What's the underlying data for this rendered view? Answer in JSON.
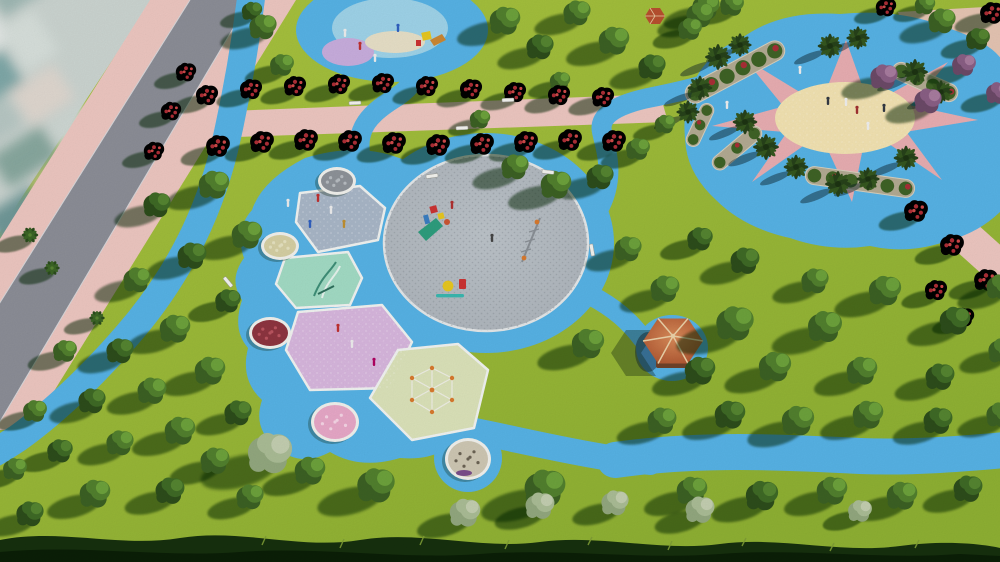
{
  "scene": {
    "title": "Aerial 3D render of a park masterplan with circular playground, sun-motif plaza, gazebo and tree-lined paths",
    "objects": [
      {
        "name": "city-backdrop",
        "label": "blurred city blocks beyond road"
      },
      {
        "name": "main-road",
        "label": "diagonal asphalt road with pink sidewalks"
      },
      {
        "name": "roadside-blue-path",
        "label": "blue walking path parallel to road"
      },
      {
        "name": "flower-promenade",
        "label": "pink promenade lined with red flowering trees"
      },
      {
        "name": "central-playground",
        "label": "blue play zone with grey circular plaza and play patches"
      },
      {
        "name": "play-patches",
        "label": "slate, mint, lilac and lime coloured play surfaces"
      },
      {
        "name": "flower-planters",
        "label": "round white-rim planters with pebbles and flowers"
      },
      {
        "name": "sun-plaza",
        "label": "blue plaza with cream sun and pink rays ringed by palms"
      },
      {
        "name": "gazebo",
        "label": "hexagonal terracotta-roof gazebo on blue pad"
      },
      {
        "name": "tree-field",
        "label": "lawn with rows of round trees casting long shadows"
      },
      {
        "name": "foreground-hedge",
        "label": "dark grass hedge silhouette along bottom edge"
      }
    ],
    "palette": {
      "grass1": "#aac43f",
      "grass2": "#8fb133",
      "blue": "#57b3e6",
      "blue2": "#6fc0ec",
      "pink_walk": "#eec7c1",
      "road": "#8c8e97",
      "curb": "#d9d9dc",
      "plaza_gray": "#bdc4ca",
      "plaza_speck": "#8f969d",
      "sun_cream": "#f3e3b2",
      "ray_pink": "#e9aeb2",
      "patch_slate": "#a9b7c8",
      "patch_mint": "#a3dcc5",
      "patch_lilac": "#d8b7de",
      "patch_lime": "#dce3ba",
      "patch_border": "#f2f4f2",
      "roof1": "#d98b59",
      "roof2": "#a84e2b",
      "ridge": "#ecd2a8",
      "deck": "#6e422a",
      "stone": "#b3ab93",
      "shrub": "#3f6326",
      "shrub_red": "#a82f36",
      "tree_g1": "#3c6124",
      "tree_g2": "#52802e",
      "tree_g3": "#6da23c",
      "tree_d1": "#2d4d1b",
      "tree_d2": "#3f6a26",
      "tree_d3": "#558531",
      "tree_p1": "#93a87f",
      "tree_p2": "#abbd96",
      "tree_p3": "#c4cfb1",
      "tree_u1": "#6c4a68",
      "tree_u2": "#8a5f85",
      "tree_u3": "#a87c9f",
      "tree_n1": "#2b4c1c",
      "tree_n2": "#3c6526",
      "tree_n3": "#588433",
      "palm_1": "#27421a",
      "palm_2": "#35571f",
      "palm_3": "#1d3312",
      "red_dot1": "#ad2e36",
      "red_dot2": "#cf4a4a",
      "shadow": "rgba(12,34,10,0.5)",
      "hedge1": "#16300e",
      "hedge2": "#0b1f07",
      "hedge_lit": "#7f9e36",
      "city_base": "#ccd5d1"
    },
    "trees": [
      [
        "d",
        252,
        12,
        0.6
      ],
      [
        "g",
        263,
        28,
        0.8
      ],
      [
        "g",
        282,
        66,
        0.7
      ],
      [
        "g",
        505,
        22,
        0.9
      ],
      [
        "d",
        540,
        48,
        0.8
      ],
      [
        "g",
        577,
        14,
        0.8
      ],
      [
        "g",
        614,
        42,
        0.9
      ],
      [
        "d",
        652,
        68,
        0.8
      ],
      [
        "g",
        690,
        30,
        0.7
      ],
      [
        "g",
        706,
        8,
        0.8
      ],
      [
        "g",
        560,
        82,
        0.6
      ],
      [
        "g",
        480,
        120,
        0.6
      ],
      [
        "g",
        515,
        168,
        0.8
      ],
      [
        "g",
        556,
        186,
        0.9
      ],
      [
        "d",
        600,
        178,
        0.8
      ],
      [
        "g",
        638,
        150,
        0.7
      ],
      [
        "g",
        665,
        125,
        0.6
      ],
      [
        "g",
        700,
        16,
        0.8
      ],
      [
        "g",
        732,
        6,
        0.7
      ],
      [
        "r",
        886,
        8,
        0.6
      ],
      [
        "g",
        925,
        6,
        0.6
      ],
      [
        "g",
        942,
        22,
        0.8
      ],
      [
        "d",
        978,
        40,
        0.7
      ],
      [
        "r",
        992,
        14,
        0.7
      ],
      [
        "u",
        884,
        78,
        0.8
      ],
      [
        "u",
        928,
        102,
        0.8
      ],
      [
        "u",
        964,
        66,
        0.7
      ],
      [
        "u",
        998,
        94,
        0.7
      ],
      [
        "r",
        207,
        96,
        0.65
      ],
      [
        "r",
        251,
        90,
        0.65
      ],
      [
        "r",
        295,
        87,
        0.65
      ],
      [
        "r",
        339,
        85,
        0.65
      ],
      [
        "r",
        383,
        84,
        0.65
      ],
      [
        "r",
        427,
        87,
        0.65
      ],
      [
        "r",
        471,
        90,
        0.65
      ],
      [
        "r",
        515,
        93,
        0.65
      ],
      [
        "r",
        559,
        96,
        0.65
      ],
      [
        "r",
        603,
        98,
        0.65
      ],
      [
        "r",
        218,
        147,
        0.7
      ],
      [
        "r",
        262,
        143,
        0.7
      ],
      [
        "r",
        306,
        141,
        0.7
      ],
      [
        "r",
        350,
        142,
        0.7
      ],
      [
        "r",
        394,
        144,
        0.7
      ],
      [
        "r",
        438,
        146,
        0.7
      ],
      [
        "r",
        482,
        145,
        0.7
      ],
      [
        "r",
        526,
        143,
        0.7
      ],
      [
        "r",
        570,
        141,
        0.7
      ],
      [
        "r",
        614,
        142,
        0.7
      ],
      [
        "r",
        186,
        73,
        0.6
      ],
      [
        "r",
        171,
        112,
        0.6
      ],
      [
        "r",
        154,
        152,
        0.6
      ],
      [
        "r",
        916,
        212,
        0.7
      ],
      [
        "r",
        952,
        246,
        0.7
      ],
      [
        "r",
        986,
        281,
        0.7
      ],
      [
        "r",
        936,
        291,
        0.65
      ],
      [
        "r",
        964,
        318,
        0.6
      ],
      [
        "g",
        214,
        186,
        0.9
      ],
      [
        "d",
        157,
        206,
        0.8
      ],
      [
        "n",
        30,
        235,
        0.75
      ],
      [
        "g",
        247,
        236,
        0.9
      ],
      [
        "d",
        192,
        257,
        0.85
      ],
      [
        "n",
        52,
        268,
        0.7
      ],
      [
        "g",
        137,
        281,
        0.8
      ],
      [
        "d",
        228,
        302,
        0.75
      ],
      [
        "n",
        97,
        318,
        0.7
      ],
      [
        "g",
        175,
        330,
        0.9
      ],
      [
        "d",
        120,
        352,
        0.8
      ],
      [
        "g",
        65,
        352,
        0.7
      ],
      [
        "g",
        210,
        372,
        0.9
      ],
      [
        "g",
        152,
        392,
        0.85
      ],
      [
        "d",
        92,
        402,
        0.8
      ],
      [
        "g",
        35,
        412,
        0.7
      ],
      [
        "d",
        238,
        414,
        0.8
      ],
      [
        "g",
        180,
        432,
        0.9
      ],
      [
        "g",
        120,
        444,
        0.8
      ],
      [
        "d",
        60,
        452,
        0.75
      ],
      [
        "g",
        15,
        470,
        0.7
      ],
      [
        "g",
        215,
        462,
        0.85
      ],
      [
        "p",
        270,
        455,
        1.3
      ],
      [
        "g",
        95,
        495,
        0.9
      ],
      [
        "d",
        170,
        492,
        0.85
      ],
      [
        "g",
        250,
        498,
        0.8
      ],
      [
        "d",
        30,
        515,
        0.8
      ],
      [
        "g",
        310,
        472,
        0.9
      ],
      [
        "g",
        376,
        487,
        1.1
      ],
      [
        "g",
        545,
        490,
        1.2
      ],
      [
        "p",
        465,
        514,
        0.9
      ],
      [
        "p",
        540,
        507,
        0.85
      ],
      [
        "p",
        615,
        504,
        0.8
      ],
      [
        "p",
        700,
        511,
        0.85
      ],
      [
        "p",
        860,
        512,
        0.7
      ],
      [
        "g",
        628,
        250,
        0.8
      ],
      [
        "g",
        665,
        290,
        0.85
      ],
      [
        "g",
        588,
        345,
        0.95
      ],
      [
        "d",
        700,
        240,
        0.75
      ],
      [
        "g",
        735,
        325,
        1.1
      ],
      [
        "g",
        825,
        328,
        1.0
      ],
      [
        "g",
        885,
        292,
        0.95
      ],
      [
        "d",
        955,
        322,
        0.9
      ],
      [
        "d",
        745,
        262,
        0.85
      ],
      [
        "g",
        815,
        282,
        0.8
      ],
      [
        "g",
        1000,
        288,
        0.8
      ],
      [
        "d",
        700,
        372,
        0.9
      ],
      [
        "g",
        775,
        368,
        0.95
      ],
      [
        "g",
        862,
        372,
        0.9
      ],
      [
        "d",
        940,
        378,
        0.85
      ],
      [
        "g",
        1002,
        352,
        0.8
      ],
      [
        "g",
        662,
        422,
        0.85
      ],
      [
        "d",
        730,
        416,
        0.9
      ],
      [
        "g",
        798,
        422,
        0.95
      ],
      [
        "g",
        868,
        416,
        0.9
      ],
      [
        "d",
        938,
        422,
        0.85
      ],
      [
        "g",
        1000,
        416,
        0.8
      ],
      [
        "g",
        692,
        492,
        0.9
      ],
      [
        "d",
        762,
        497,
        0.95
      ],
      [
        "g",
        832,
        492,
        0.9
      ],
      [
        "g",
        902,
        497,
        0.9
      ],
      [
        "d",
        968,
        490,
        0.85
      ],
      [
        "m",
        718,
        57,
        1
      ],
      [
        "m",
        740,
        45,
        0.9
      ],
      [
        "m",
        700,
        88,
        0.95
      ],
      [
        "m",
        830,
        46,
        0.95
      ],
      [
        "m",
        858,
        38,
        0.9
      ],
      [
        "m",
        915,
        72,
        1
      ],
      [
        "m",
        941,
        92,
        0.9
      ],
      [
        "m",
        745,
        122,
        0.95
      ],
      [
        "m",
        766,
        147,
        1
      ],
      [
        "m",
        796,
        167,
        0.95
      ],
      [
        "m",
        838,
        184,
        1
      ],
      [
        "m",
        868,
        179,
        0.9
      ],
      [
        "m",
        906,
        158,
        0.95
      ],
      [
        "m",
        688,
        112,
        0.9
      ]
    ],
    "people": {
      "plaza": [
        [
          800,
          72,
          "#f0f0f0"
        ],
        [
          828,
          103,
          "#333a44"
        ],
        [
          846,
          104,
          "#f0f0f0"
        ],
        [
          857,
          112,
          "#a03030"
        ],
        [
          884,
          110,
          "#333a44"
        ],
        [
          727,
          107,
          "#f0f0f0"
        ],
        [
          868,
          128,
          "#f0f0f0"
        ]
      ],
      "circle": [
        [
          492,
          240,
          "#444444"
        ],
        [
          452,
          207,
          "#b03030"
        ]
      ],
      "patches": [
        [
          318,
          200,
          "#c03030"
        ],
        [
          331,
          212,
          "#eeeeee"
        ],
        [
          344,
          226,
          "#c09030"
        ],
        [
          310,
          226,
          "#3060c0"
        ],
        [
          288,
          205,
          "#eeeeee"
        ],
        [
          338,
          330,
          "#c03030"
        ],
        [
          352,
          346,
          "#eeeeee"
        ],
        [
          374,
          364,
          "#b00060"
        ]
      ],
      "top_playground": [
        [
          360,
          48,
          "#c03030"
        ],
        [
          375,
          60,
          "#eeeeee"
        ],
        [
          398,
          30,
          "#3060c0"
        ],
        [
          345,
          35,
          "#eeeeee"
        ]
      ]
    },
    "benches": [
      [
        432,
        176,
        -8
      ],
      [
        548,
        172,
        6
      ],
      [
        592,
        250,
        80
      ],
      [
        355,
        103,
        -3
      ],
      [
        462,
        128,
        -3
      ],
      [
        508,
        100,
        -3
      ],
      [
        228,
        282,
        50
      ]
    ],
    "planters": [
      {
        "x": 337,
        "y": 181,
        "rx": 16,
        "ry": 11,
        "fill": "#8e9399",
        "dots": "#b8bdc2"
      },
      {
        "x": 280,
        "y": 246,
        "rx": 16,
        "ry": 11,
        "fill": "#d6d0a4",
        "dots": "#e6e2c0"
      },
      {
        "x": 270,
        "y": 333,
        "rx": 18,
        "ry": 13,
        "fill": "#8e3540",
        "dots": "#bb5560"
      },
      {
        "x": 335,
        "y": 422,
        "rx": 21,
        "ry": 17,
        "fill": "#e8a8c8",
        "dots": "#f6d6e6"
      },
      {
        "x": 468,
        "y": 459,
        "rx": 20,
        "ry": 18,
        "fill": "#cfc8b4",
        "dots": "#6b6354",
        "accent": "#7a4e8a"
      }
    ],
    "plaza_beds": [
      {
        "x": 735,
        "y": 72,
        "r": -28,
        "w": 110,
        "h": 20
      },
      {
        "x": 925,
        "y": 82,
        "r": 24,
        "w": 70,
        "h": 18
      },
      {
        "x": 860,
        "y": 182,
        "r": 8,
        "w": 110,
        "h": 18
      },
      {
        "x": 737,
        "y": 148,
        "r": -40,
        "w": 60,
        "h": 15
      },
      {
        "x": 700,
        "y": 125,
        "r": -65,
        "w": 46,
        "h": 14
      }
    ]
  }
}
